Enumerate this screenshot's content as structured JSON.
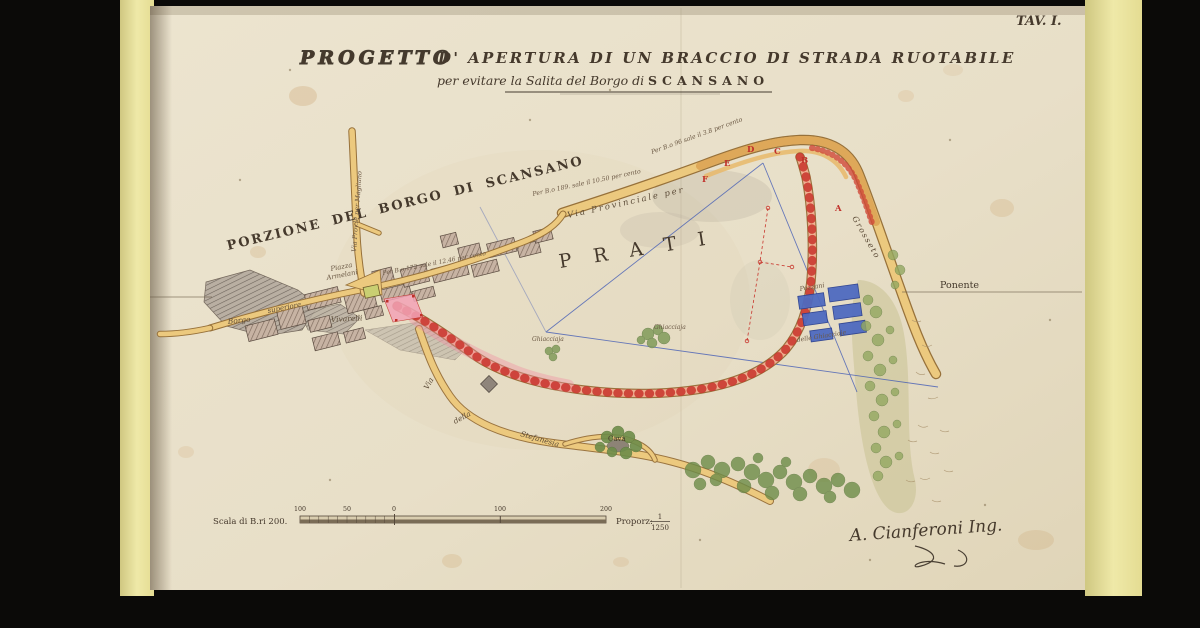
{
  "plate": {
    "tav": "TAV. I."
  },
  "title": {
    "word1": "PROGETTO",
    "rest": "D' APERTURA DI UN BRACCIO DI STRADA RUOTABILE",
    "sub_prefix": "per evitare la Salita del Borgo di",
    "sub_place": "SCANSANO"
  },
  "map": {
    "porzione": "PORZIONE DEL BORGO DI SCANSANO",
    "via_magliano": "Via Prov.le per Magliano",
    "piazza_line1": "Piazza",
    "piazza_line2": "Armelani",
    "vivarelli": "Vivarelli",
    "borgo": "Borgo",
    "superiore": "superiore",
    "prati": "PRATI",
    "via_provinciale": "Via Provinciale per",
    "grosseto": "Grosseto",
    "ann_189": "Per B.o 189. sale il 10.50 per cento",
    "ann_96": "Per B.o 96 sale il 3.8 per cento",
    "ann_172": "Per B.o 172 sale il 12.46 per cento",
    "ponente": "Ponente",
    "pozzani": "Pozzani",
    "ghiacciaje": "delle Ghiacciaje",
    "ghiacciaja_a": "Ghiacciaja",
    "ghiacciaja_b": "Ghiacciaja",
    "via": "Via",
    "della": "della",
    "stefanesia": "Stefanesia",
    "cava": "Cava",
    "points": [
      "A",
      "B",
      "C",
      "D",
      "E",
      "F"
    ]
  },
  "scale": {
    "label": "Scala di B.ri 200.",
    "ticks": [
      "100",
      "50",
      "0",
      "100",
      "200"
    ],
    "proporz": "Proporz:",
    "ratio_num": "1",
    "ratio_den": "1250"
  },
  "signature": {
    "name": "A. Cianferoni Ing."
  },
  "colors": {
    "paper": "#e8dfc8",
    "road_yellow": "#ecc97e",
    "project_pink": "#ef8fa3",
    "station_red": "#c03028",
    "water_blue": "#4f6ac0",
    "line_blue": "#3a55b5",
    "vegetation": "#7f9b5a",
    "ink": "#45392c"
  }
}
